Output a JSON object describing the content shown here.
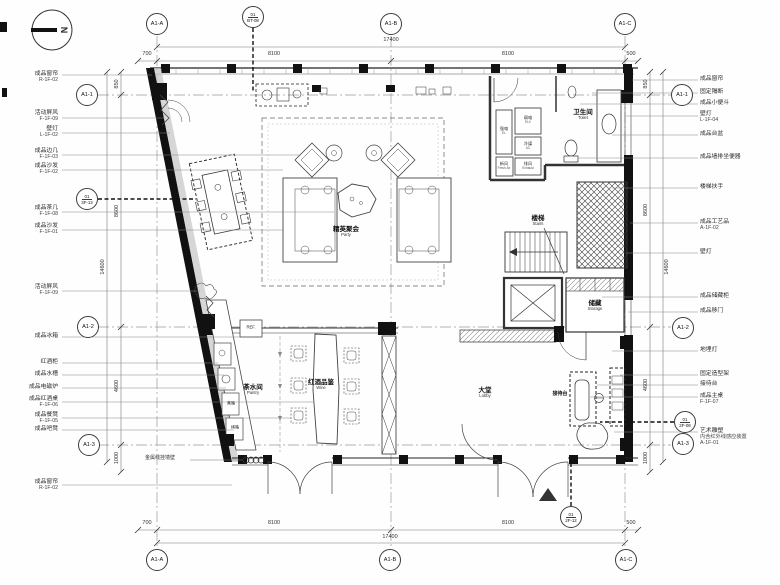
{
  "north_label": "N",
  "grid": {
    "top": [
      "A1-A",
      "A1-B",
      "A1-C"
    ],
    "bottom": [
      "A1-A",
      "A1-B",
      "A1-C"
    ],
    "left": [
      "A1-1",
      "A1-2",
      "A1-3"
    ],
    "right": [
      "A1-1",
      "A1-2",
      "A1-3"
    ]
  },
  "details": {
    "top": {
      "num": "01",
      "sheet": "BT-08"
    },
    "left": {
      "num": "01",
      "sheet": "3F-13"
    },
    "right": {
      "num": "01",
      "sheet": "2F-08"
    },
    "bottom": {
      "num": "01",
      "sheet": "2F-12"
    }
  },
  "dimensions": {
    "top": {
      "total": "17400",
      "segments": [
        "700",
        "8100",
        "8100",
        "500"
      ]
    },
    "bottom": {
      "total": "17400",
      "segments": [
        "700",
        "8100",
        "8100",
        "500"
      ]
    },
    "left": {
      "total": "14600",
      "segments": [
        "850",
        "8600",
        "4600",
        "1000"
      ]
    },
    "right": {
      "total": "14600",
      "segments": [
        "850",
        "8600",
        "4600",
        "1000"
      ]
    }
  },
  "rooms": {
    "toilet": {
      "cn": "卫生间",
      "en": "Toilet"
    },
    "stairs": {
      "cn": "楼梯",
      "en": "Stairs"
    },
    "storage": {
      "cn": "储藏",
      "en": "Storage"
    },
    "party": {
      "cn": "精英聚会",
      "en": "Party"
    },
    "pantry": {
      "cn": "茶水间",
      "en": "Pantry"
    },
    "wine": {
      "cn": "红酒品鉴",
      "en": "Wine"
    },
    "lobby": {
      "cn": "大堂",
      "en": "Lobby"
    },
    "reception": {
      "cn": "接待台",
      "en": ""
    }
  },
  "shafts": [
    {
      "cn": "强电",
      "en": "EL"
    },
    {
      "cn": "弱电",
      "en": "ELV"
    },
    {
      "cn": "冷媒",
      "en": "AC"
    },
    {
      "cn": "新风",
      "en": "Fresh Air"
    },
    {
      "cn": "排风",
      "en": "Exhaust"
    }
  ],
  "equipment": {
    "fridge": "REF.",
    "steamer": "蒸箱",
    "oven": "烤箱"
  },
  "wall_note": "金属线挂墙壁",
  "annotations_left": [
    {
      "label": "成品窗帘",
      "code": "R-1F-02"
    },
    {
      "label": "活动屏风",
      "code": "F-1F-09"
    },
    {
      "label": "壁灯",
      "code": "L-1F-02"
    },
    {
      "label": "成品边几",
      "code": "F-1F-03"
    },
    {
      "label": "成品沙发",
      "code": "F-1F-02"
    },
    {
      "label": "成品茶几",
      "code": "F-1F-08"
    },
    {
      "label": "成品沙发",
      "code": "F-1F-01"
    },
    {
      "label": "活动屏风",
      "code": "F-1F-09"
    },
    {
      "label": "成品冰箱",
      "code": ""
    },
    {
      "label": "红酒柜",
      "code": ""
    },
    {
      "label": "成品水槽",
      "code": ""
    },
    {
      "label": "成品电磁炉",
      "code": ""
    },
    {
      "label": "成品红酒桌",
      "code": "F-1F-06"
    },
    {
      "label": "成品餐凳",
      "code": "F-1F-05"
    },
    {
      "label": "成品吧凳",
      "code": ""
    },
    {
      "label": "成品窗帘",
      "code": "R-1F-02"
    }
  ],
  "annotations_right": [
    {
      "label": "成品窗帘",
      "code": ""
    },
    {
      "label": "固定隔断",
      "code": ""
    },
    {
      "label": "成品小便斗",
      "code": ""
    },
    {
      "label": "壁灯",
      "code": "L-1F-04"
    },
    {
      "label": "成品台盆",
      "code": ""
    },
    {
      "label": "成品墙排坐便器",
      "code": ""
    },
    {
      "label": "楼梯扶手",
      "code": ""
    },
    {
      "label": "成品工艺品",
      "code": "A-1F-02"
    },
    {
      "label": "壁灯",
      "code": ""
    },
    {
      "label": "成品储藏柜",
      "code": ""
    },
    {
      "label": "成品移门",
      "code": ""
    },
    {
      "label": "地埋灯",
      "code": ""
    },
    {
      "label": "固定造型架",
      "code": ""
    },
    {
      "label": "接待台",
      "code": ""
    },
    {
      "label": "成品主桌",
      "code": "F-1F-07"
    },
    {
      "label": "艺术雕塑",
      "code": "内含红外线感应装置",
      "code2": "A-1F-01"
    }
  ],
  "colors": {
    "ink": "#2a2a2a",
    "wall_fill": "#111111"
  }
}
